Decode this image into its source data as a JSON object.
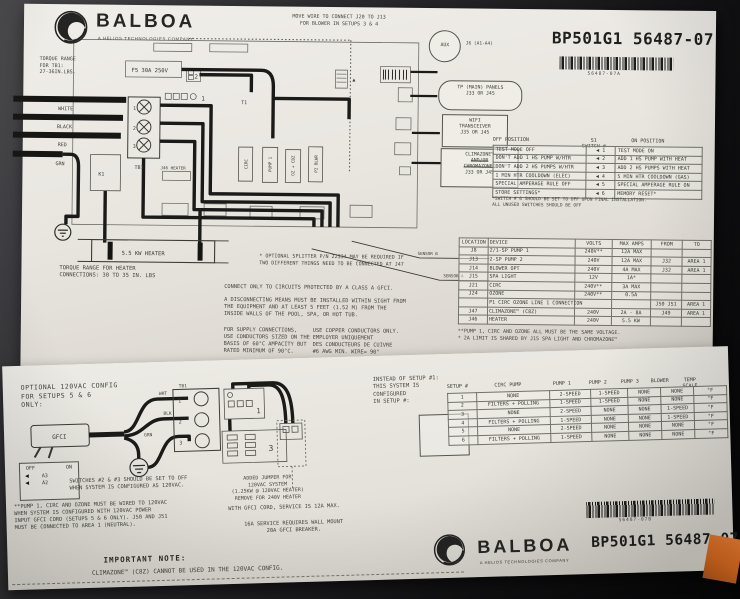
{
  "sheet_a": {
    "brand": {
      "name": "BALBOA",
      "tagline": "A HELIOS TECHNOLOGIES COMPANY"
    },
    "part_number": "BP501G1 56487-07",
    "barcode_caption": "56487-07A",
    "part_label": "PART A",
    "top_note": [
      "MOVE WIRE TO CONNECT J20 TO J13",
      "FOR BLOWER IN SETUPS 3 & 4"
    ],
    "torque_tb1": [
      "TORQUE RANGE",
      "FOR TB1:",
      "27-36IN.LBS."
    ],
    "heater_torque": [
      "TORQUE RANGE FOR HEATER",
      "CONNECTIONS: 30 TO 35 IN. LBS"
    ],
    "splitter_note": [
      "* OPTIONAL SPLITTER P/N 22334 MAY BE REQUIRED IF",
      "TWO DIFFERENT THINGS NEED TO BE CONNECTED AT J47"
    ],
    "callouts": {
      "aux": "AUX",
      "aux_ref": "J6 (A1-A4)",
      "panels": [
        "TP (MAIN) PANELS",
        "J33 OR J45"
      ],
      "wifi": [
        "WIFI",
        "TRANSCEIVER",
        "J35 OR J45"
      ],
      "clima1": "CLIMAZONE™",
      "clima2": "AND/OR",
      "clima3": "CHROMAZONE™",
      "clima4": "J33 OR J45"
    },
    "switch_table": {
      "headers": [
        "OFF POSITION",
        "S1 SWITCH #",
        "ON POSITION"
      ],
      "rows": [
        [
          "TEST MODE OFF",
          "◀ 1",
          "TEST MODE ON"
        ],
        [
          "DON'T ADD 1 HS PUMP W/HTR",
          "◀ 2",
          "ADD 1 HS PUMP WITH HEAT"
        ],
        [
          "DON'T ADD 2 HS PUMPS W/HTR",
          "◀ 3",
          "ADD 2 HS PUMPS WITH HEAT"
        ],
        [
          "1 MIN HTR COOLDOWN (ELEC)",
          "◀ 4",
          "5 MIN HTR COOLDOWN (GAS)"
        ],
        [
          "SPECIAL AMPERAGE RULE OFF",
          "◀ 5",
          "SPECIAL AMPERAGE RULE ON"
        ],
        [
          "STORE SETTINGS*",
          "◀ 6",
          "MEMORY RESET*"
        ]
      ],
      "footnotes": [
        "*SWITCH # 6 SHOULD BE SET TO OFF UPON FINAL INSTALLATION.",
        "ALL UNUSED SWITCHES SHOULD BE OFF"
      ]
    },
    "location_table": {
      "headers": [
        "LOCATION",
        "DEVICE",
        "VOLTS",
        "MAX AMPS",
        "FROM",
        "TO"
      ],
      "rows": [
        [
          "J8",
          "2/1-SP PUMP 1",
          "240V**",
          "12A MAX",
          "",
          ""
        ],
        [
          "J13",
          "2-SP PUMP 2",
          "240V",
          "12A MAX",
          "J32",
          "AREA 1"
        ],
        [
          "J14",
          "BLOWER OPT",
          "240V",
          "4A MAX",
          "J32",
          "AREA 1"
        ],
        [
          "J15",
          "SPA LIGHT",
          "12V",
          "1A*",
          "",
          ""
        ],
        [
          "J21",
          "CIRC",
          "240V**",
          "3A MAX",
          "",
          ""
        ],
        [
          "J24",
          "OZONE",
          "240V**",
          "0.5A",
          "",
          ""
        ],
        [
          "",
          "P1 CIRC OZONE LINE 1 CONNECTION",
          "",
          "",
          "J50 J51",
          "AREA 1"
        ],
        [
          "J47",
          "CLIMAZONE™ (C8Z)",
          "240V",
          "2A - 8A",
          "J49",
          "AREA 1"
        ],
        [
          "J46",
          "HEATER",
          "240V",
          "5.5 KW",
          "",
          ""
        ]
      ],
      "notes": [
        "**PUMP 1, CIRC AND OZONE ALL MUST BE THE SAME VOLTAGE.",
        "* 2A LIMIT IS SHARED BY J15 SPA LIGHT AND CHROMAZONE™"
      ]
    },
    "safety": {
      "gfci": "CONNECT ONLY TO CIRCUITS PROTECTED BY A CLASS A GFCI.",
      "disconnect": [
        "A DISCONNECTING MEANS MUST BE INSTALLED WITHIN SIGHT FROM",
        "THE EQUIPMENT AND AT LEAST 5 FEET (1.52 M) FROM THE",
        "INSIDE WALLS OF THE POOL, SPA, OR HOT TUB."
      ],
      "supply": [
        "FOR SUPPLY CONNECTIONS,",
        "USE CONDUCTORS SIZED ON THE",
        "BASIS OF 60°C AMPACITY BUT",
        "RATED MINIMUM OF 90°C."
      ],
      "copper": [
        "USE COPPER CONDUCTORS ONLY.",
        "EMPLOYER UNIQUEMENT",
        "DES CONDUCTEURS DE CUIVRE",
        "#6 AWG MIN. WIRE= 90°"
      ]
    },
    "diagram": {
      "tb1": "TB1",
      "f5": "F5 30A 250V",
      "t1": "T1",
      "k1": "K1",
      "block1": "1",
      "conn2": "2",
      "heater": "5.5 KW HEATER",
      "j46": "J46 HEATER",
      "sensor_a": "SENSOR A",
      "sensor_b": "SENSOR B",
      "wires": [
        "WHITE",
        "BLACK",
        "RED",
        "GRN"
      ],
      "relays": [
        "CIRC",
        "PUMP 1",
        "OZ + CBZ",
        "P2 BLWR"
      ],
      "terminals": [
        "1",
        "2",
        "3"
      ]
    }
  },
  "sheet_b": {
    "optional_config": [
      "OPTIONAL 120VAC CONFIG",
      "FOR SETUPS 5 & 6",
      "ONLY:"
    ],
    "dip": {
      "off": "OFF",
      "on": "ON",
      "arrow": "◀",
      "rows": [
        "A3",
        "A2"
      ]
    },
    "switches_note": [
      "SWITCHES #2 & #3 SHOULD BE SET TO OFF",
      "WHEN SYSTEM IS CONFIGURED AS 120VAC."
    ],
    "pump_note": [
      "**PUMP 1, CIRC AND OZONE MUST BE WIRED TO 120VAC",
      "WHEN SYSTEM IS CONFIGURED WITH 120VAC POWER",
      "INPUT GFCI CORD (SETUPS 5 & 6 ONLY). J50 AND J51",
      "MUST BE CONNECTED TO AREA 1 (NEUTRAL)."
    ],
    "jumper_note": [
      "ADDED JUMPER FOR",
      "120VAC SYSTEM",
      "(1.25KW @ 120VAC HEATER)",
      "REMOVE FOR 240V HEATER"
    ],
    "gfci_cord_note": "WITH GFCI CORD, SERVICE IS 12A MAX.",
    "service_note": [
      "16A SERVICE REQUIRES WALL MOUNT",
      "20A GFCI  BREAKER."
    ],
    "important_title": "IMPORTANT NOTE:",
    "important_body": "CLIMAZONE™ (C8Z) CANNOT BE USED IN THE 120VAC CONFIG.",
    "instead_note": [
      "INSTEAD OF SETUP #1:",
      "THIS SYSTEM IS",
      "CONFIGURED",
      "IN SETUP #:"
    ],
    "setup_table": {
      "headers": [
        "SETUP #",
        "CIRC PUMP",
        "PUMP 1",
        "PUMP 2",
        "PUMP 3",
        "BLOWER",
        "TEMP SCALE"
      ],
      "rows": [
        [
          "1",
          "NONE",
          "2-SPEED",
          "1-SPEED",
          "NONE",
          "NONE",
          "°F"
        ],
        [
          "2",
          "FILTERS + POLLING",
          "1-SPEED",
          "1-SPEED",
          "NONE",
          "NONE",
          "°F"
        ],
        [
          "3",
          "NONE",
          "2-SPEED",
          "NONE",
          "NONE",
          "1-SPEED",
          "°F"
        ],
        [
          "4",
          "FILTERS + POLLING",
          "1-SPEED",
          "NONE",
          "NONE",
          "1-SPEED",
          "°F"
        ],
        [
          "5",
          "NONE",
          "2-SPEED",
          "NONE",
          "NONE",
          "NONE",
          "°F"
        ],
        [
          "6",
          "FILTERS + POLLING",
          "1-SPEED",
          "NONE",
          "NONE",
          "NONE",
          "°F"
        ]
      ]
    },
    "brand": {
      "name": "BALBOA",
      "tagline": "A HELIOS TECHNOLOGIES COMPANY"
    },
    "part_number": "BP501G1 56487-07",
    "barcode_caption": "56487-07B",
    "part_label": "PART B",
    "diagram": {
      "gfci": "GFCI",
      "tb1": "TB1",
      "terminals": [
        "1",
        "2",
        "3"
      ],
      "wht": "WHT",
      "blk": "BLK",
      "grn": "GRN",
      "block1": "1",
      "block3": "3"
    }
  }
}
